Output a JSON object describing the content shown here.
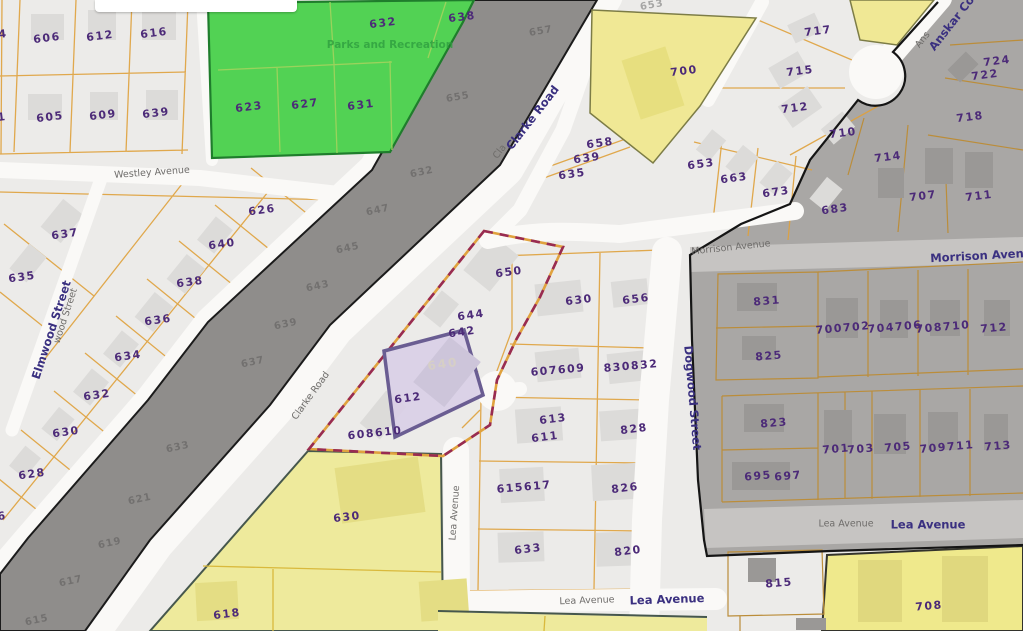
{
  "map": {
    "type": "parcel-gis-map",
    "zones": {
      "park": {
        "label": "Parks and Recreation",
        "color": "#52d254"
      },
      "highlighted_parcel": {
        "label": "640",
        "fill": "#d9cfe6",
        "stroke": "#6a5d92"
      },
      "selection_boundary": {
        "dash_color": "#982b52",
        "base_color": "#e0a23e"
      },
      "road_corridor": {
        "color": "#8f8d8b"
      },
      "shaded_district": {
        "color": "#a9a7a5"
      },
      "yellow_zones": {
        "color": "#f0e895"
      }
    },
    "labels": [
      {
        "text": "4",
        "x": 3,
        "y": 34,
        "cls": "parcel",
        "rot": -7
      },
      {
        "text": "606",
        "x": 47,
        "y": 38,
        "cls": "parcel",
        "rot": -7
      },
      {
        "text": "612",
        "x": 100,
        "y": 36,
        "cls": "parcel",
        "rot": -7
      },
      {
        "text": "616",
        "x": 154,
        "y": 33,
        "cls": "parcel",
        "rot": -7
      },
      {
        "text": "1",
        "x": 2,
        "y": 117,
        "cls": "parcel",
        "rot": -7
      },
      {
        "text": "605",
        "x": 50,
        "y": 117,
        "cls": "parcel",
        "rot": -7
      },
      {
        "text": "609",
        "x": 103,
        "y": 115,
        "cls": "parcel",
        "rot": -7
      },
      {
        "text": "639",
        "x": 156,
        "y": 113,
        "cls": "parcel",
        "rot": -7
      },
      {
        "text": "632",
        "x": 383,
        "y": 23,
        "cls": "parcel",
        "rot": -7
      },
      {
        "text": "638",
        "x": 462,
        "y": 17,
        "cls": "parcel",
        "rot": -7
      },
      {
        "text": "623",
        "x": 249,
        "y": 107,
        "cls": "parcel",
        "rot": -7
      },
      {
        "text": "627",
        "x": 305,
        "y": 104,
        "cls": "parcel",
        "rot": -7
      },
      {
        "text": "631",
        "x": 361,
        "y": 105,
        "cls": "parcel",
        "rot": -7
      },
      {
        "text": "Parks and Recreation",
        "x": 390,
        "y": 45,
        "cls": "park",
        "rot": 0
      },
      {
        "text": "626",
        "x": 262,
        "y": 210,
        "cls": "parcel",
        "rot": -8
      },
      {
        "text": "640",
        "x": 222,
        "y": 244,
        "cls": "parcel",
        "rot": -8
      },
      {
        "text": "637",
        "x": 65,
        "y": 234,
        "cls": "parcel",
        "rot": -8
      },
      {
        "text": "638",
        "x": 190,
        "y": 282,
        "cls": "parcel",
        "rot": -8
      },
      {
        "text": "635",
        "x": 22,
        "y": 277,
        "cls": "parcel",
        "rot": -8
      },
      {
        "text": "636",
        "x": 158,
        "y": 320,
        "cls": "parcel",
        "rot": -8
      },
      {
        "text": "634",
        "x": 128,
        "y": 356,
        "cls": "parcel",
        "rot": -8
      },
      {
        "text": "632",
        "x": 97,
        "y": 395,
        "cls": "parcel",
        "rot": -8
      },
      {
        "text": "630",
        "x": 66,
        "y": 432,
        "cls": "parcel",
        "rot": -8
      },
      {
        "text": "628",
        "x": 32,
        "y": 474,
        "cls": "parcel",
        "rot": -8
      },
      {
        "text": "6",
        "x": 2,
        "y": 516,
        "cls": "parcel",
        "rot": -8
      },
      {
        "text": "653",
        "x": 652,
        "y": 6,
        "cls": "faintl",
        "rot": -10
      },
      {
        "text": "657",
        "x": 541,
        "y": 32,
        "cls": "faint",
        "rot": -10
      },
      {
        "text": "655",
        "x": 458,
        "y": 98,
        "cls": "faint",
        "rot": -10
      },
      {
        "text": "632",
        "x": 422,
        "y": 173,
        "cls": "faint",
        "rot": -12
      },
      {
        "text": "647",
        "x": 378,
        "y": 211,
        "cls": "faint",
        "rot": -12
      },
      {
        "text": "645",
        "x": 348,
        "y": 249,
        "cls": "faint",
        "rot": -12
      },
      {
        "text": "643",
        "x": 318,
        "y": 287,
        "cls": "faint",
        "rot": -12
      },
      {
        "text": "639",
        "x": 286,
        "y": 325,
        "cls": "faint",
        "rot": -12
      },
      {
        "text": "637",
        "x": 253,
        "y": 363,
        "cls": "faint",
        "rot": -12
      },
      {
        "text": "633",
        "x": 178,
        "y": 448,
        "cls": "faint",
        "rot": -12
      },
      {
        "text": "621",
        "x": 140,
        "y": 500,
        "cls": "faint",
        "rot": -12
      },
      {
        "text": "619",
        "x": 110,
        "y": 544,
        "cls": "faint",
        "rot": -12
      },
      {
        "text": "617",
        "x": 71,
        "y": 582,
        "cls": "faint",
        "rot": -12
      },
      {
        "text": "615",
        "x": 37,
        "y": 621,
        "cls": "faint",
        "rot": -12
      },
      {
        "text": "650",
        "x": 509,
        "y": 272,
        "cls": "parcel",
        "rot": -8
      },
      {
        "text": "644",
        "x": 471,
        "y": 315,
        "cls": "parcel",
        "rot": -8
      },
      {
        "text": "642",
        "x": 462,
        "y": 332,
        "cls": "parcel",
        "rot": -8
      },
      {
        "text": "640",
        "x": 443,
        "y": 364,
        "cls": "hl",
        "rot": -8
      },
      {
        "text": "612",
        "x": 408,
        "y": 398,
        "cls": "parcel",
        "rot": -8
      },
      {
        "text": "608610",
        "x": 375,
        "y": 433,
        "cls": "parcel",
        "rot": -6
      },
      {
        "text": "658",
        "x": 600,
        "y": 143,
        "cls": "parcel",
        "rot": -8
      },
      {
        "text": "639",
        "x": 587,
        "y": 158,
        "cls": "parcel",
        "rot": -8
      },
      {
        "text": "635",
        "x": 572,
        "y": 174,
        "cls": "parcel",
        "rot": -8
      },
      {
        "text": "700",
        "x": 684,
        "y": 71,
        "cls": "parcel",
        "rot": -7
      },
      {
        "text": "630",
        "x": 579,
        "y": 300,
        "cls": "parcel",
        "rot": -7
      },
      {
        "text": "656",
        "x": 636,
        "y": 299,
        "cls": "parcel",
        "rot": -7
      },
      {
        "text": "607609",
        "x": 558,
        "y": 370,
        "cls": "parcel",
        "rot": -5
      },
      {
        "text": "830832",
        "x": 631,
        "y": 366,
        "cls": "parcel",
        "rot": -5
      },
      {
        "text": "613",
        "x": 553,
        "y": 419,
        "cls": "parcel",
        "rot": -7
      },
      {
        "text": "611",
        "x": 545,
        "y": 437,
        "cls": "parcel",
        "rot": -7
      },
      {
        "text": "828",
        "x": 634,
        "y": 429,
        "cls": "parcel",
        "rot": -7
      },
      {
        "text": "615617",
        "x": 524,
        "y": 487,
        "cls": "parcel",
        "rot": -5
      },
      {
        "text": "826",
        "x": 625,
        "y": 488,
        "cls": "parcel",
        "rot": -7
      },
      {
        "text": "633",
        "x": 528,
        "y": 549,
        "cls": "parcel",
        "rot": -7
      },
      {
        "text": "820",
        "x": 628,
        "y": 551,
        "cls": "parcel",
        "rot": -7
      },
      {
        "text": "630",
        "x": 347,
        "y": 517,
        "cls": "parcel",
        "rot": -7
      },
      {
        "text": "618",
        "x": 227,
        "y": 614,
        "cls": "parcel",
        "rot": -7
      },
      {
        "text": "717",
        "x": 818,
        "y": 31,
        "cls": "parcel",
        "rot": -7
      },
      {
        "text": "715",
        "x": 800,
        "y": 71,
        "cls": "parcel",
        "rot": -7
      },
      {
        "text": "712",
        "x": 795,
        "y": 108,
        "cls": "parcel",
        "rot": -7
      },
      {
        "text": "710",
        "x": 843,
        "y": 133,
        "cls": "parcel",
        "rot": -7
      },
      {
        "text": "653",
        "x": 701,
        "y": 164,
        "cls": "parcel",
        "rot": -8
      },
      {
        "text": "663",
        "x": 734,
        "y": 178,
        "cls": "parcel",
        "rot": -8
      },
      {
        "text": "673",
        "x": 776,
        "y": 192,
        "cls": "parcel",
        "rot": -8
      },
      {
        "text": "683",
        "x": 835,
        "y": 209,
        "cls": "parcel",
        "rot": -8
      },
      {
        "text": "724",
        "x": 997,
        "y": 61,
        "cls": "parcel",
        "rot": -7
      },
      {
        "text": "722",
        "x": 985,
        "y": 75,
        "cls": "parcel",
        "rot": -7
      },
      {
        "text": "718",
        "x": 970,
        "y": 117,
        "cls": "parcel",
        "rot": -7
      },
      {
        "text": "714",
        "x": 888,
        "y": 157,
        "cls": "parcel",
        "rot": -7
      },
      {
        "text": "707",
        "x": 923,
        "y": 196,
        "cls": "parcel",
        "rot": -7
      },
      {
        "text": "711",
        "x": 979,
        "y": 196,
        "cls": "parcel",
        "rot": -7
      },
      {
        "text": "831",
        "x": 767,
        "y": 301,
        "cls": "parcel",
        "rot": -5
      },
      {
        "text": "825",
        "x": 769,
        "y": 356,
        "cls": "parcel",
        "rot": -5
      },
      {
        "text": "700702",
        "x": 843,
        "y": 328,
        "cls": "parcel",
        "rot": -5
      },
      {
        "text": "704706",
        "x": 895,
        "y": 327,
        "cls": "parcel",
        "rot": -5
      },
      {
        "text": "708710",
        "x": 943,
        "y": 327,
        "cls": "parcel",
        "rot": -5
      },
      {
        "text": "712",
        "x": 994,
        "y": 328,
        "cls": "parcel",
        "rot": -5
      },
      {
        "text": "823",
        "x": 774,
        "y": 423,
        "cls": "parcel",
        "rot": -5
      },
      {
        "text": "695",
        "x": 758,
        "y": 476,
        "cls": "parcel",
        "rot": -5
      },
      {
        "text": "697",
        "x": 788,
        "y": 476,
        "cls": "parcel",
        "rot": -5
      },
      {
        "text": "701",
        "x": 836,
        "y": 449,
        "cls": "parcel",
        "rot": -5
      },
      {
        "text": "703",
        "x": 861,
        "y": 449,
        "cls": "parcel",
        "rot": -5
      },
      {
        "text": "705",
        "x": 898,
        "y": 447,
        "cls": "parcel",
        "rot": -5
      },
      {
        "text": "709711",
        "x": 947,
        "y": 447,
        "cls": "parcel",
        "rot": -5
      },
      {
        "text": "713",
        "x": 998,
        "y": 446,
        "cls": "parcel",
        "rot": -5
      },
      {
        "text": "815",
        "x": 779,
        "y": 583,
        "cls": "parcel",
        "rot": -5
      },
      {
        "text": "708",
        "x": 929,
        "y": 606,
        "cls": "parcel",
        "rot": -5
      },
      {
        "text": "Westley Avenue",
        "x": 152,
        "y": 173,
        "cls": "st",
        "rot": -4
      },
      {
        "text": "wood Street",
        "x": 66,
        "y": 316,
        "cls": "st",
        "rot": -72
      },
      {
        "text": "Elmwood Street",
        "x": 52,
        "y": 330,
        "cls": "stb",
        "rot": -72
      },
      {
        "text": "Cla",
        "x": 500,
        "y": 152,
        "cls": "st",
        "rot": -52
      },
      {
        "text": "Clarke Road",
        "x": 533,
        "y": 118,
        "cls": "stb",
        "rot": -52
      },
      {
        "text": "Clarke Road",
        "x": 311,
        "y": 396,
        "cls": "st",
        "rot": -54
      },
      {
        "text": "Morrison Avenue",
        "x": 731,
        "y": 248,
        "cls": "st",
        "rot": -6
      },
      {
        "text": "Morrison Avenue",
        "x": 985,
        "y": 256,
        "cls": "stb",
        "rot": -3
      },
      {
        "text": "Dogwood Street",
        "x": 692,
        "y": 398,
        "cls": "stb",
        "rot": 85
      },
      {
        "text": "Ans",
        "x": 923,
        "y": 40,
        "cls": "st",
        "rot": -52
      },
      {
        "text": "Anskar Court",
        "x": 958,
        "y": 16,
        "cls": "stb",
        "rot": -52
      },
      {
        "text": "Lea Avenue",
        "x": 455,
        "y": 513,
        "cls": "st",
        "rot": -86
      },
      {
        "text": "Lea Avenue",
        "x": 587,
        "y": 601,
        "cls": "st",
        "rot": -2
      },
      {
        "text": "Lea Avenue",
        "x": 667,
        "y": 600,
        "cls": "stb",
        "rot": -2
      },
      {
        "text": "Lea Avenue",
        "x": 846,
        "y": 524,
        "cls": "st",
        "rot": 0
      },
      {
        "text": "Lea Avenue",
        "x": 928,
        "y": 525,
        "cls": "stb",
        "rot": 0
      }
    ]
  }
}
